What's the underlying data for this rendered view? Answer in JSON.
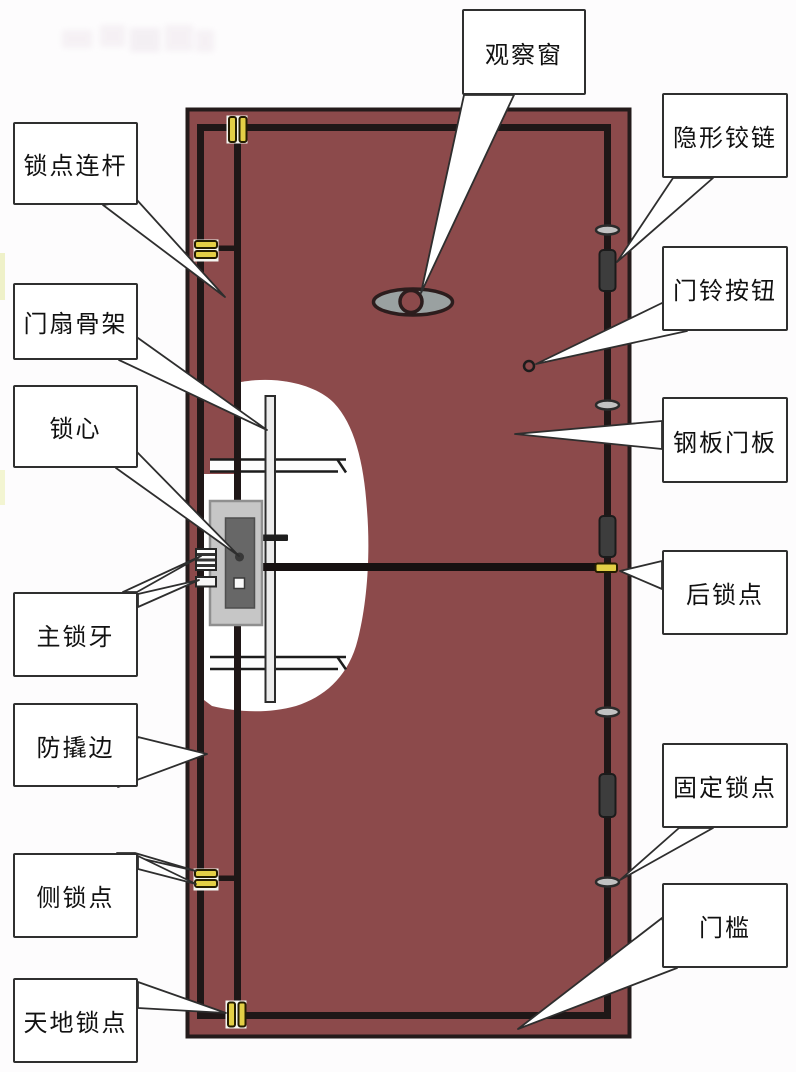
{
  "diagram": {
    "subject": "security-door-structure-diagram"
  },
  "labels": {
    "left": [
      {
        "id": "lock-point-linkage-rod",
        "text": "锁点连杆"
      },
      {
        "id": "door-leaf-frame",
        "text": "门扇骨架"
      },
      {
        "id": "lock-core",
        "text": "锁心"
      },
      {
        "id": "main-lock-bolt",
        "text": "主锁牙"
      },
      {
        "id": "anti-pry-edge",
        "text": "防撬边"
      },
      {
        "id": "side-lock-point",
        "text": "侧锁点"
      },
      {
        "id": "top-bottom-lock-point",
        "text": "天地锁点"
      }
    ],
    "right": [
      {
        "id": "peephole",
        "text": "观察窗"
      },
      {
        "id": "hidden-hinge",
        "text": "隐形铰链"
      },
      {
        "id": "doorbell-button",
        "text": "门铃按钮"
      },
      {
        "id": "steel-door-panel",
        "text": "钢板门板"
      },
      {
        "id": "rear-lock-point",
        "text": "后锁点"
      },
      {
        "id": "fixed-lock-point",
        "text": "固定锁点"
      },
      {
        "id": "door-sill",
        "text": "门槛"
      }
    ]
  },
  "colors": {
    "background": "#fdfcfd",
    "door_panel_maroon": "#8c4a4b",
    "outline_black": "#1f1717",
    "lock_point_yellow": "#e3cf46",
    "hinge_dark_gray": "#3d3d3d",
    "cap_gray": "#c2c2c2",
    "lock_body_gray": "#c6c6c6",
    "lock_core_gray": "#676767",
    "peephole_glass_gray": "#9aa1a1",
    "cutaway_white": "#ffffff"
  }
}
